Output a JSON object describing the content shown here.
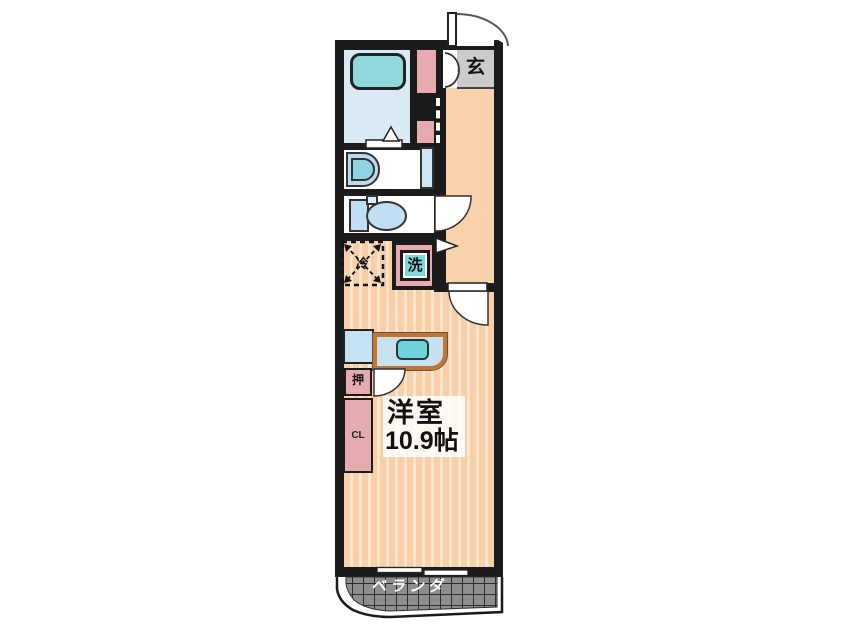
{
  "plan": {
    "title": "ワンルーム間取り図",
    "entrance": {
      "label": "玄"
    },
    "laundry": {
      "label": "洗"
    },
    "refrigerator": {
      "label": "冷"
    },
    "oshiire": {
      "label": "押"
    },
    "closet": {
      "label": "CL"
    },
    "main_room": {
      "name": "洋室",
      "size": "10.9帖"
    },
    "veranda": {
      "label": "ベランダ"
    }
  },
  "colors": {
    "wall": "#1b1b1b",
    "floor-base": "#f8cfa8",
    "floor-stripe": "#fbe4ca",
    "hallway": "#f8d2ac",
    "entrance-gray": "#cbcbcd",
    "bath-floor": "#d9eaf5",
    "fixture-blue": "#c2def2",
    "fixture-teal": "#8fd9dd",
    "accent-pink": "#e5abb0",
    "counter-orange": "#c8742c",
    "veranda-gray": "#8e8e8e"
  }
}
